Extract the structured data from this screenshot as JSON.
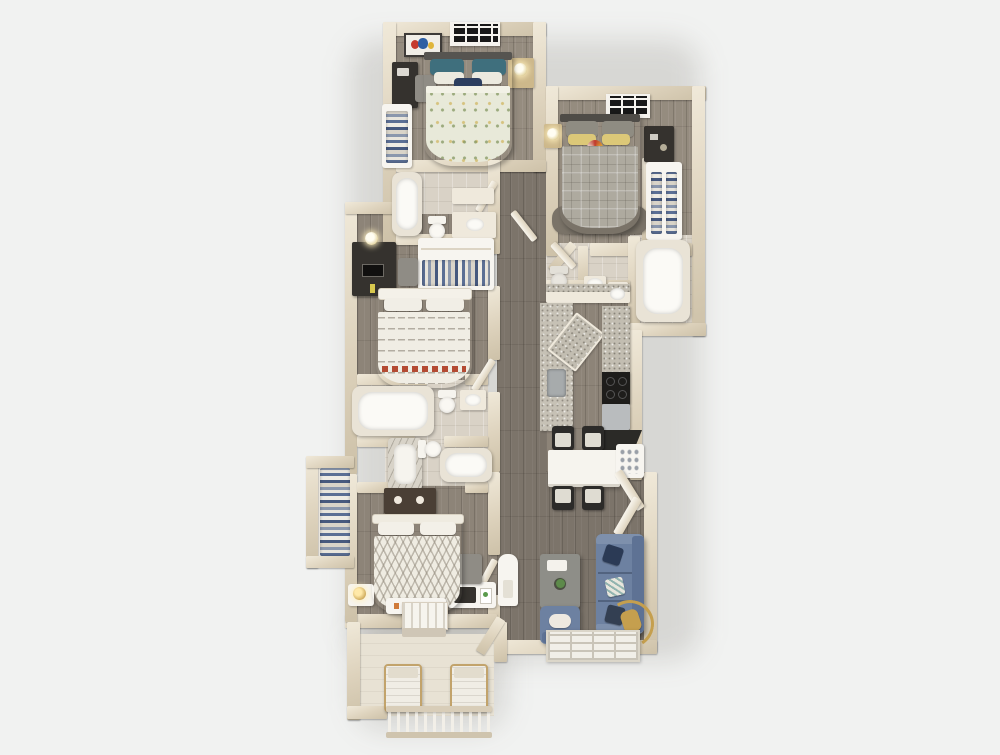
{
  "meta": {
    "type": "3d-floor-plan-rendering",
    "view": "top-down",
    "canvas_width": 1000,
    "canvas_height": 755
  },
  "palette": {
    "background": "#f1f2f1",
    "wall_light": "#ece4d2",
    "wall_dark": "#cdc1a8",
    "wood_floor": "#8d8478",
    "bath_floor": "#d9d2c6",
    "balcony_floor": "#e8e2d4",
    "closet_floor": "#f0ece3",
    "duvet_sage": "#e8e9d9",
    "pillow_teal": "#3f6f7d",
    "duvet_plaid_gray": "#aeaa9f",
    "pillow_yellow": "#dcc878",
    "duvet_white": "#f0ede4",
    "sofa_blue": "#6d81a1",
    "accent_navy": "#2c3e5f",
    "accent_gold": "#c59f4e",
    "accent_red": "#b44a32",
    "furniture_dark": "#35322e",
    "furniture_tan": "#c2a36b",
    "granite": "#c2bdb1",
    "chair_dark": "#2c2b29",
    "white_fixture": "#f7f5f0"
  },
  "rooms": {
    "bedroom1": {
      "name": "Bedroom 1 (top) - bed with sage patterned duvet, teal pillows, wall art, window, nightstand with lamp, desk with chair, closet with hanging clothes"
    },
    "bedroom2": {
      "name": "Bedroom 2 (top right) - gray plaid bed, yellow pillows, round rainbow pillow, window, nightstand with lamp, desk, closet with hanging clothes, rug"
    },
    "bedroom3": {
      "name": "Bedroom 3 (middle left) - white striped bed with red accent, dark desk with monitor, chair, closet shelving with clothes"
    },
    "bedroom4": {
      "name": "Bedroom 4 (bottom left) - white chevron bed, dark dresser, bench, side table with gold lamp, desk with printer, chair, closet with hanging clothes"
    },
    "bathroom1": {
      "name": "Bathroom 1 (top middle) - bathtub, toilet, vanity sink"
    },
    "bathroom2": {
      "name": "Bathroom 2 (right) - toilet, two sinks, garden tub room"
    },
    "bathroom3": {
      "name": "Bathroom 3 (lower middle) - bathtub, toilet, sink, marble shower, second tub"
    },
    "kitchen": {
      "name": "Kitchen - galley counters with granite tops, sink, angled island, black range, dishwasher, dark counter"
    },
    "dining": {
      "name": "Dining area - white table with four dark chairs"
    },
    "living": {
      "name": "Living room - blue sectional sofa with pillows, blue armchair, coffee table with plant and tray, gold arc floor lamp, window"
    },
    "hallway": {
      "name": "Hallway - wood floor, interior doors, utility closet"
    },
    "pantry": {
      "name": "Pantry closet with open angled doors and shelving"
    },
    "balcony": {
      "name": "Balcony - front door, two lounge chairs, baluster railing"
    }
  }
}
